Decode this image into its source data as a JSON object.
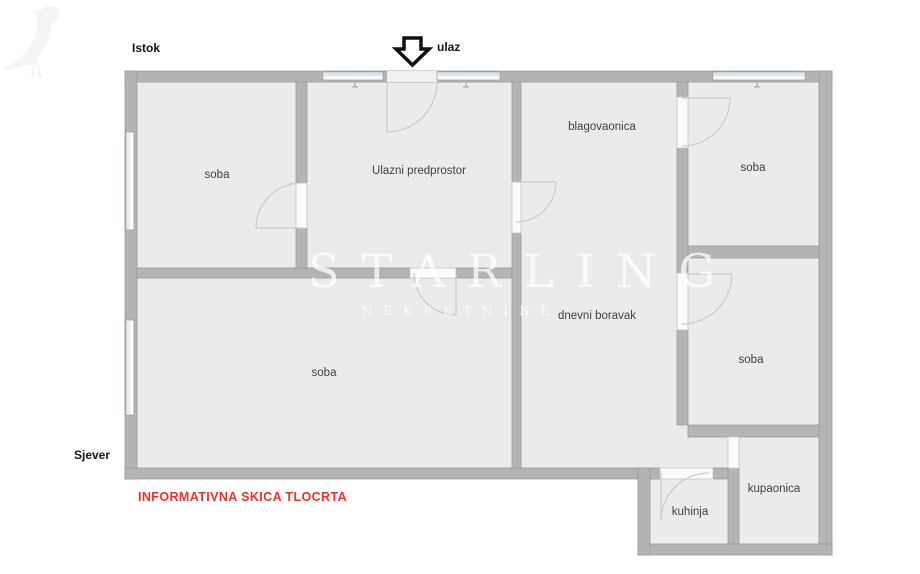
{
  "compass": {
    "east_label": "Istok",
    "north_label": "Sjever"
  },
  "entrance": {
    "label": "ulaz",
    "arrow_icon": "down-arrow"
  },
  "rooms": [
    {
      "id": "soba-top-left",
      "label": "soba"
    },
    {
      "id": "ulazni-predprostor",
      "label": "Ulazni predprostor"
    },
    {
      "id": "blagovaonica",
      "label": "blagovaonica"
    },
    {
      "id": "soba-top-right",
      "label": "soba"
    },
    {
      "id": "soba-large",
      "label": "soba"
    },
    {
      "id": "dnevni-boravak",
      "label": "dnevni boravak"
    },
    {
      "id": "soba-middle-right",
      "label": "soba"
    },
    {
      "id": "kuhinja",
      "label": "kuhinja"
    },
    {
      "id": "kupaonica",
      "label": "kupaonica"
    }
  ],
  "watermark": {
    "brand": "STARLING",
    "subtitle": "NEKRETNINE",
    "bird_icon": "starling-bird"
  },
  "footer": {
    "disclaimer": "INFORMATIVNA SKICA TLOCRTA"
  },
  "colors": {
    "wall_gray": "#b4b4b4",
    "room_fill": "#ebebeb",
    "window_blue": "#d9e5ef",
    "disclaimer_red": "#e53232",
    "label_text": "#414141"
  }
}
